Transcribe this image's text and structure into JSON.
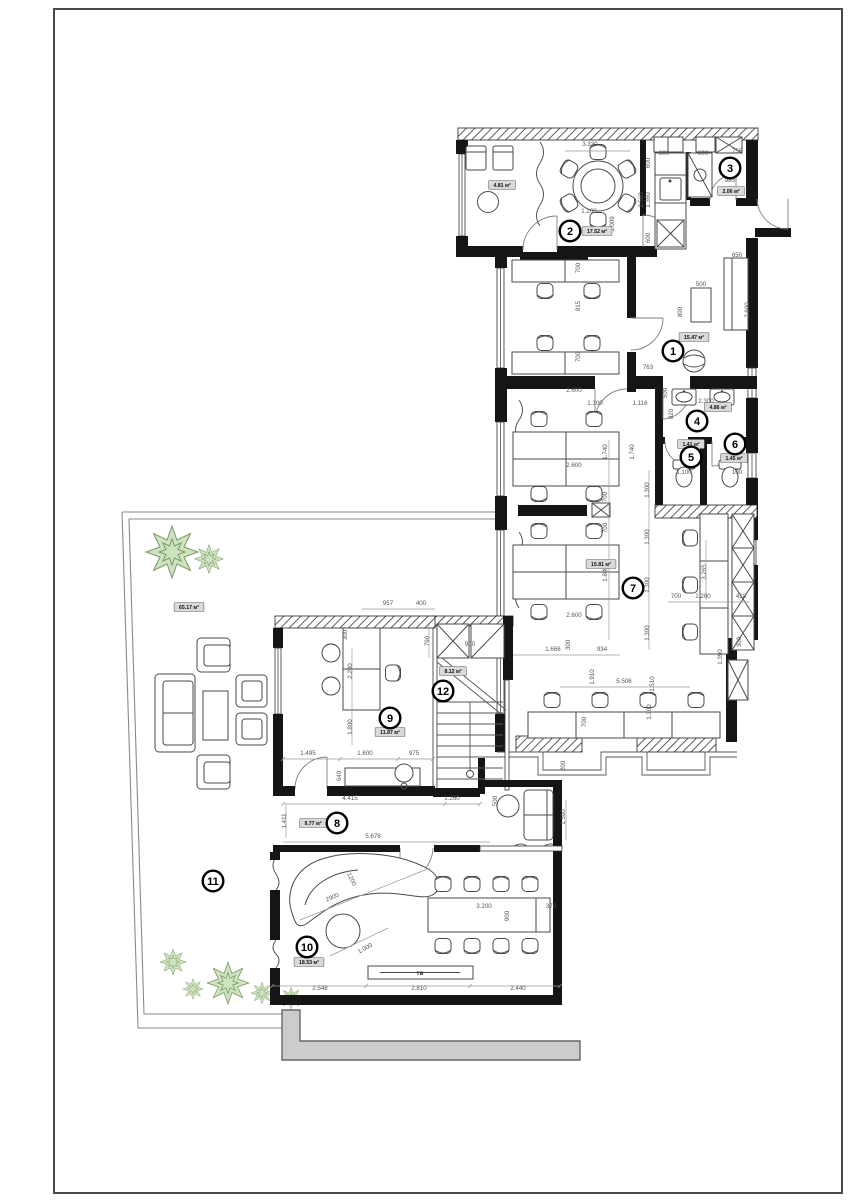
{
  "colors": {
    "wall": "#151515",
    "line": "#4a4a4a",
    "dim": "#555555",
    "paper": "#ffffff",
    "tree_fill": "#cfe3c0",
    "tree_stroke": "#7a9a68",
    "walkway": "#cccccc",
    "frame": "#4a4a4a"
  },
  "room_markers": [
    {
      "num": "1",
      "x": 673,
      "y": 351
    },
    {
      "num": "2",
      "x": 570,
      "y": 231
    },
    {
      "num": "3",
      "x": 730,
      "y": 168
    },
    {
      "num": "4",
      "x": 697,
      "y": 421
    },
    {
      "num": "5",
      "x": 691,
      "y": 457
    },
    {
      "num": "6",
      "x": 735,
      "y": 444
    },
    {
      "num": "7",
      "x": 633,
      "y": 588
    },
    {
      "num": "8",
      "x": 337,
      "y": 823
    },
    {
      "num": "9",
      "x": 390,
      "y": 718
    },
    {
      "num": "10",
      "x": 307,
      "y": 947
    },
    {
      "num": "11",
      "x": 213,
      "y": 881
    },
    {
      "num": "12",
      "x": 443,
      "y": 691
    }
  ],
  "area_labels": [
    {
      "text": "4.81 м²",
      "x": 502,
      "y": 185
    },
    {
      "text": "17.52 м²",
      "x": 597,
      "y": 231
    },
    {
      "text": "2.06 м²",
      "x": 731,
      "y": 191
    },
    {
      "text": "15.47 м²",
      "x": 694,
      "y": 337
    },
    {
      "text": "4.86 м²",
      "x": 718,
      "y": 407
    },
    {
      "text": "1.41 м²",
      "x": 691,
      "y": 444
    },
    {
      "text": "1.45 м²",
      "x": 734,
      "y": 458
    },
    {
      "text": "15.81 м²",
      "x": 601,
      "y": 564
    },
    {
      "text": "9.77 м²",
      "x": 313,
      "y": 823
    },
    {
      "text": "11.87 м²",
      "x": 390,
      "y": 732
    },
    {
      "text": "18.53 м²",
      "x": 309,
      "y": 962
    },
    {
      "text": "65.17 м²",
      "x": 189,
      "y": 607
    },
    {
      "text": "8.12 м²",
      "x": 453,
      "y": 671
    }
  ],
  "dimensions": [
    {
      "t": "3.330",
      "x": 590,
      "y": 146,
      "r": 0
    },
    {
      "t": "1.200",
      "x": 589,
      "y": 213,
      "r": 0
    },
    {
      "t": "1.009",
      "x": 614,
      "y": 224,
      "r": -90
    },
    {
      "t": "600",
      "x": 650,
      "y": 163,
      "r": -90
    },
    {
      "t": "2.560",
      "x": 643,
      "y": 200,
      "r": -90
    },
    {
      "t": "1.360",
      "x": 650,
      "y": 200,
      "r": -90
    },
    {
      "t": "600",
      "x": 650,
      "y": 238,
      "r": -90
    },
    {
      "t": "800",
      "x": 664,
      "y": 155,
      "r": 0
    },
    {
      "t": "800",
      "x": 703,
      "y": 155,
      "r": 0
    },
    {
      "t": "755",
      "x": 737,
      "y": 153,
      "r": 0
    },
    {
      "t": "985",
      "x": 730,
      "y": 182,
      "r": 0
    },
    {
      "t": "700",
      "x": 580,
      "y": 268,
      "r": -90
    },
    {
      "t": "815",
      "x": 580,
      "y": 306,
      "r": -90
    },
    {
      "t": "700",
      "x": 580,
      "y": 357,
      "r": -90
    },
    {
      "t": "650",
      "x": 737,
      "y": 257,
      "r": 0
    },
    {
      "t": "500",
      "x": 701,
      "y": 286,
      "r": 0
    },
    {
      "t": "800",
      "x": 682,
      "y": 312,
      "r": -90
    },
    {
      "t": "2.600",
      "x": 749,
      "y": 310,
      "r": -90
    },
    {
      "t": "763",
      "x": 648,
      "y": 369,
      "r": 0
    },
    {
      "t": "500",
      "x": 667,
      "y": 393,
      "r": -90
    },
    {
      "t": "2.300",
      "x": 706,
      "y": 403,
      "r": 0
    },
    {
      "t": "820",
      "x": 673,
      "y": 414,
      "r": -90
    },
    {
      "t": "1.100",
      "x": 684,
      "y": 474,
      "r": 0
    },
    {
      "t": "100",
      "x": 737,
      "y": 474,
      "r": 0
    },
    {
      "t": "2.600",
      "x": 574,
      "y": 392,
      "r": 0
    },
    {
      "t": "1.300",
      "x": 595,
      "y": 405,
      "r": 0
    },
    {
      "t": "1.116",
      "x": 640,
      "y": 405,
      "r": 0
    },
    {
      "t": "1.740",
      "x": 607,
      "y": 452,
      "r": -90
    },
    {
      "t": "1.740",
      "x": 634,
      "y": 452,
      "r": -90
    },
    {
      "t": "2.600",
      "x": 574,
      "y": 467,
      "r": 0
    },
    {
      "t": "700",
      "x": 607,
      "y": 497,
      "r": -90
    },
    {
      "t": "700",
      "x": 607,
      "y": 528,
      "r": -90
    },
    {
      "t": "1.800",
      "x": 607,
      "y": 574,
      "r": -90
    },
    {
      "t": "2.600",
      "x": 574,
      "y": 617,
      "r": 0
    },
    {
      "t": "1.300",
      "x": 649,
      "y": 490,
      "r": -90
    },
    {
      "t": "1.300",
      "x": 649,
      "y": 537,
      "r": -90
    },
    {
      "t": "1.300",
      "x": 649,
      "y": 585,
      "r": -90
    },
    {
      "t": "1.300",
      "x": 649,
      "y": 633,
      "r": -90
    },
    {
      "t": "1.300",
      "x": 651,
      "y": 712,
      "r": -90
    },
    {
      "t": "3.265",
      "x": 706,
      "y": 572,
      "r": -90
    },
    {
      "t": "700",
      "x": 676,
      "y": 598,
      "r": 0
    },
    {
      "t": "1.200",
      "x": 703,
      "y": 598,
      "r": 0
    },
    {
      "t": "418",
      "x": 741,
      "y": 598,
      "r": 0
    },
    {
      "t": "1.390",
      "x": 722,
      "y": 657,
      "r": -90
    },
    {
      "t": "300",
      "x": 741,
      "y": 642,
      "r": -90
    },
    {
      "t": "1.666",
      "x": 553,
      "y": 651,
      "r": 0
    },
    {
      "t": "934",
      "x": 602,
      "y": 651,
      "r": 0
    },
    {
      "t": "300",
      "x": 570,
      "y": 645,
      "r": -90
    },
    {
      "t": "1.910",
      "x": 594,
      "y": 677,
      "r": -90
    },
    {
      "t": "1.510",
      "x": 654,
      "y": 684,
      "r": -90
    },
    {
      "t": "5.506",
      "x": 624,
      "y": 683,
      "r": 0
    },
    {
      "t": "700",
      "x": 586,
      "y": 722,
      "r": -90
    },
    {
      "t": "200",
      "x": 565,
      "y": 766,
      "r": -90
    },
    {
      "t": "957",
      "x": 388,
      "y": 605,
      "r": 0
    },
    {
      "t": "400",
      "x": 421,
      "y": 605,
      "r": 0
    },
    {
      "t": "790",
      "x": 429,
      "y": 641,
      "r": -90
    },
    {
      "t": "900",
      "x": 470,
      "y": 646,
      "r": 0
    },
    {
      "t": "300",
      "x": 347,
      "y": 635,
      "r": -90
    },
    {
      "t": "2.200",
      "x": 352,
      "y": 671,
      "r": -90
    },
    {
      "t": "1.800",
      "x": 352,
      "y": 727,
      "r": -90
    },
    {
      "t": "1.495",
      "x": 308,
      "y": 755,
      "r": 0
    },
    {
      "t": "1.600",
      "x": 365,
      "y": 755,
      "r": 0
    },
    {
      "t": "975",
      "x": 414,
      "y": 755,
      "r": 0
    },
    {
      "t": "640",
      "x": 341,
      "y": 776,
      "r": -90
    },
    {
      "t": "4.415",
      "x": 350,
      "y": 800,
      "r": 0
    },
    {
      "t": "1.260",
      "x": 452,
      "y": 800,
      "r": 0
    },
    {
      "t": "5.678",
      "x": 373,
      "y": 838,
      "r": 0
    },
    {
      "t": "1.411",
      "x": 286,
      "y": 821,
      "r": -90
    },
    {
      "t": "500",
      "x": 497,
      "y": 801,
      "r": -90
    },
    {
      "t": "1.500",
      "x": 565,
      "y": 817,
      "r": -90
    },
    {
      "t": "2900",
      "x": 333,
      "y": 899,
      "r": -22
    },
    {
      "t": "1200",
      "x": 350,
      "y": 880,
      "r": 64
    },
    {
      "t": "1.000",
      "x": 366,
      "y": 950,
      "r": -30
    },
    {
      "t": "3.200",
      "x": 484,
      "y": 908,
      "r": 0
    },
    {
      "t": "900",
      "x": 509,
      "y": 916,
      "r": -90
    },
    {
      "t": "370",
      "x": 551,
      "y": 908,
      "r": 0
    },
    {
      "t": "2.548",
      "x": 320,
      "y": 990,
      "r": 0
    },
    {
      "t": "2.810",
      "x": 419,
      "y": 990,
      "r": 0
    },
    {
      "t": "2.440",
      "x": 518,
      "y": 990,
      "r": 0
    }
  ],
  "text_labels": [
    {
      "t": "тв",
      "x": 420,
      "y": 975
    }
  ]
}
